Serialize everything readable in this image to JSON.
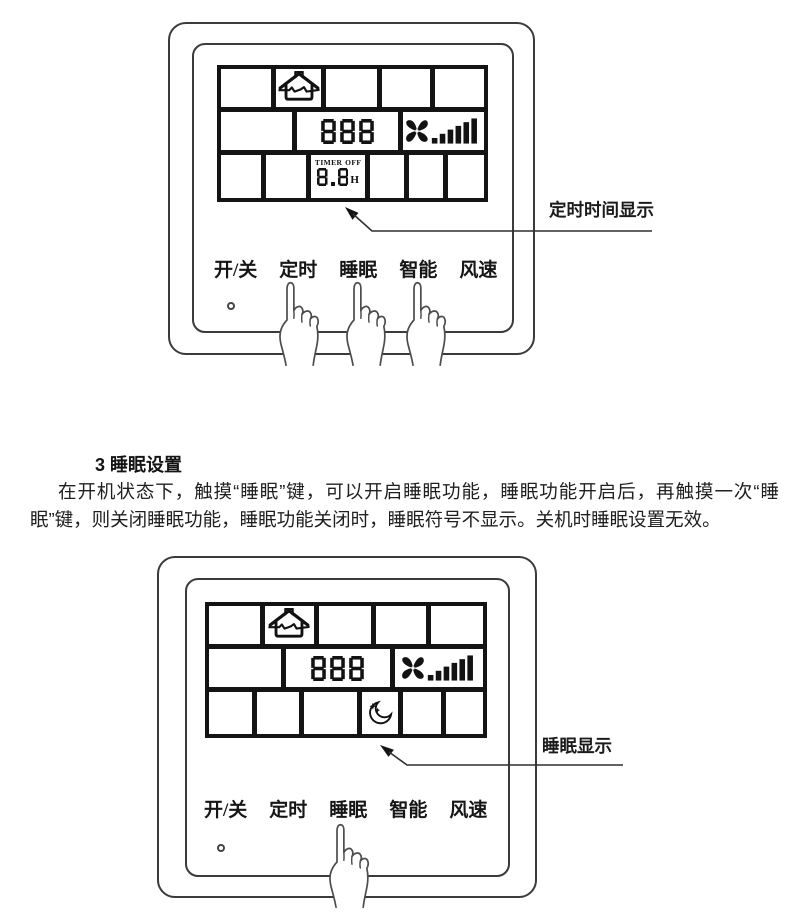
{
  "colors": {
    "line": "#3b3b3b",
    "display_line": "#141414",
    "text": "#1c1c1c"
  },
  "figure_top": {
    "display": {
      "house_icon": "house-airflow-icon",
      "value": "888",
      "fan_icon": "fan-speed-icon",
      "timer": {
        "label": "TIMER",
        "state": "OFF",
        "value": "8.8",
        "unit": "H"
      }
    },
    "buttons": [
      {
        "label": "开/关"
      },
      {
        "label": "定时"
      },
      {
        "label": "睡眠"
      },
      {
        "label": "智能"
      },
      {
        "label": "风速"
      }
    ],
    "callout": {
      "label": "定时时间显示"
    }
  },
  "section": {
    "heading": "3 睡眠设置",
    "body": "在开机状态下，触摸“睡眠”键，可以开启睡眠功能，睡眠功能开启后，再触摸一次“睡眠”键，则关闭睡眠功能，睡眠功能关闭时，睡眠符号不显示。关机时睡眠设置无效。"
  },
  "figure_bottom": {
    "display": {
      "house_icon": "house-airflow-icon",
      "value": "888",
      "fan_icon": "fan-speed-icon",
      "sleep_icon": "moon-stars-icon"
    },
    "buttons": [
      {
        "label": "开/关"
      },
      {
        "label": "定时"
      },
      {
        "label": "睡眠"
      },
      {
        "label": "智能"
      },
      {
        "label": "风速"
      }
    ],
    "callout": {
      "label": "睡眠显示"
    }
  }
}
